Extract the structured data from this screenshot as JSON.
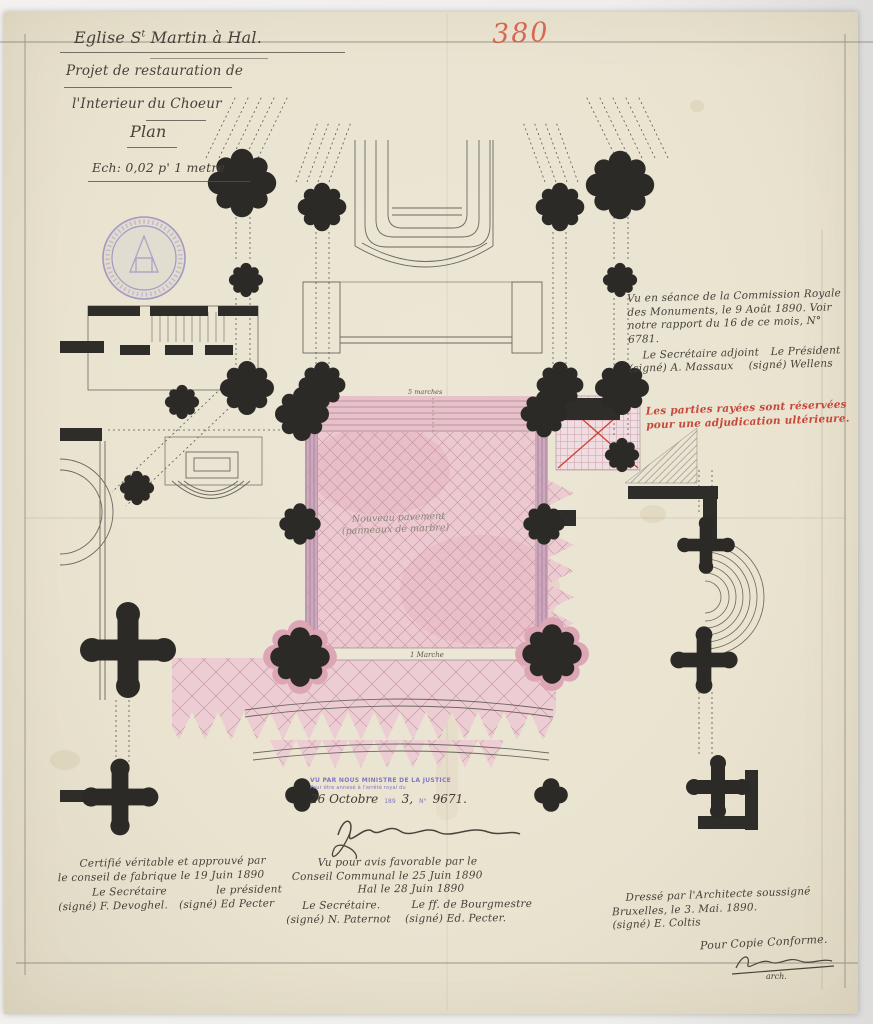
{
  "page": {
    "inventory_number": "380",
    "title": {
      "part1": "Eglise S",
      "sup": "t",
      "part2": " Martin à Hal.",
      "line2": "Projet de restauration de",
      "line3": "l'Interieur du Choeur",
      "line4": "Plan",
      "scale": "Ech: 0,02 p' 1 metre"
    },
    "commission_note": {
      "line1": "Vu en séance de la Commission Royale",
      "line2": "des Monuments, le 9 Août 1890. Voir",
      "line3": "notre rapport du 16 de ce mois, N° 6781.",
      "secretary_title": "Le Secrétaire adjoint",
      "president_title": "Le Président",
      "secretary_sig": "(signé) A. Massaux",
      "president_sig": "(signé) Wellens"
    },
    "red_note": {
      "line1": "Les parties rayées sont réservées",
      "line2": "pour une adjudication ultérieure."
    },
    "plan_labels": {
      "top_steps": "5 marches",
      "pavement1": "Nouveau pavement",
      "pavement2": "(panneaux de marbre)",
      "bottom_step": "1 Marche"
    },
    "ministry_stamp": {
      "line1": "VU PAR NOUS MINISTRE DE LA JUSTICE",
      "line2": "Pour être annexé à l'arrêté royal du",
      "hand_date": "26 Octobre",
      "year_printed": "189",
      "hand_year": "3,",
      "number_label": "N°",
      "hand_number": "9671."
    },
    "fabric_note": {
      "line1": "Certifié véritable et approuvé par",
      "line2": "le conseil de fabrique le 19 Juin 1890",
      "secretary_title": "Le Secrétaire",
      "president_title": "le président",
      "secretary_sig": "(signé) F. Devoghel.",
      "president_sig": "(signé) Ed Pecter"
    },
    "communal_note": {
      "line1": "Vu pour avis favorable par le",
      "line2": "Conseil Communal le 25 Juin 1890",
      "line3": "Hal le 28 Juin 1890",
      "secretary_title": "Le Secrétaire.",
      "mayor_title": "Le ff. de Bourgmestre",
      "secretary_sig": "(signé) N. Paternot",
      "mayor_sig": "(signé) Ed. Pecter."
    },
    "architect_note": {
      "line1": "Dressé par l'Architecte soussigné",
      "line2": "Bruxelles, le 3. Mai. 1890.",
      "line3": "(signé) E. Coltis",
      "copy_line": "Pour Copie Conforme.",
      "sig_caption": "arch."
    },
    "colors": {
      "paper": "#ebe6d4",
      "ink": "#46413a",
      "red_ink": "#c7473a",
      "pink_wash": "#e9c3cb",
      "stamp_violet": "#8277c2"
    }
  }
}
